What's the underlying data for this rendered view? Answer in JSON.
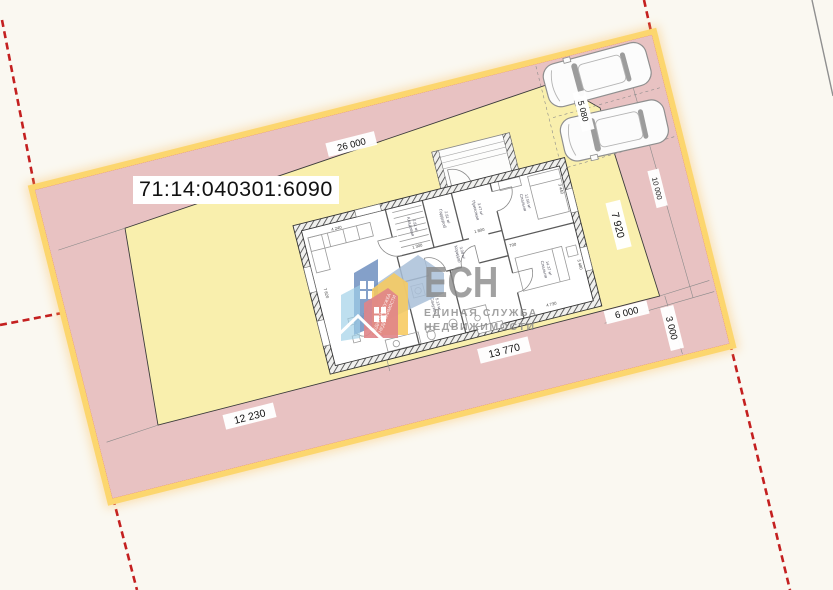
{
  "canvas": {
    "background": "#faf8f1"
  },
  "parcel": {
    "cadastral_number": "71:14:040301:6090",
    "fill": "#e8c2c2",
    "buildable_fill": "#f9efad",
    "border_band": "#fcd66e",
    "border_line": "#e2503e",
    "boundary_dash_color": "#c42020",
    "dims": {
      "inner_top": "26 000",
      "inner_bottom_left": "12 230",
      "inner_bottom_right": "13 770",
      "buildable_right_height": "7 920",
      "right_side": "10 000",
      "parking_width": "5 080",
      "corner_right": "6 000",
      "corner_bottom": "3 000"
    }
  },
  "house": {
    "rooms": [
      {
        "name": "Кухня-гостиная",
        "area": "27.24 м²"
      },
      {
        "name": "Кладовая",
        "area": "2.81 м²"
      },
      {
        "name": "Гардероб",
        "area": "2.81 м²"
      },
      {
        "name": "Прихожая",
        "area": "3.47 м²"
      },
      {
        "name": "Спальня",
        "area": "12.56 м²"
      },
      {
        "name": "Коридор",
        "area": "3.08 м²"
      },
      {
        "name": "Санузел",
        "area": "5.13 м²"
      },
      {
        "name": "Спальня",
        "area": "14.37 м²"
      }
    ],
    "wall_dims": [
      "4 240",
      "7 820",
      "1 300",
      "1 800",
      "3 440",
      "700",
      "4 730",
      "3 480"
    ]
  },
  "watermark": {
    "abbr": "ЕСН",
    "line1": "ЕДИНАЯ СЛУЖБА",
    "line2": "НЕДВИЖИМОСТИ",
    "diagonal1": "ЕДИНАЯ СЛУЖБА",
    "diagonal2": "НЕДВИЖИМОСТИ"
  }
}
